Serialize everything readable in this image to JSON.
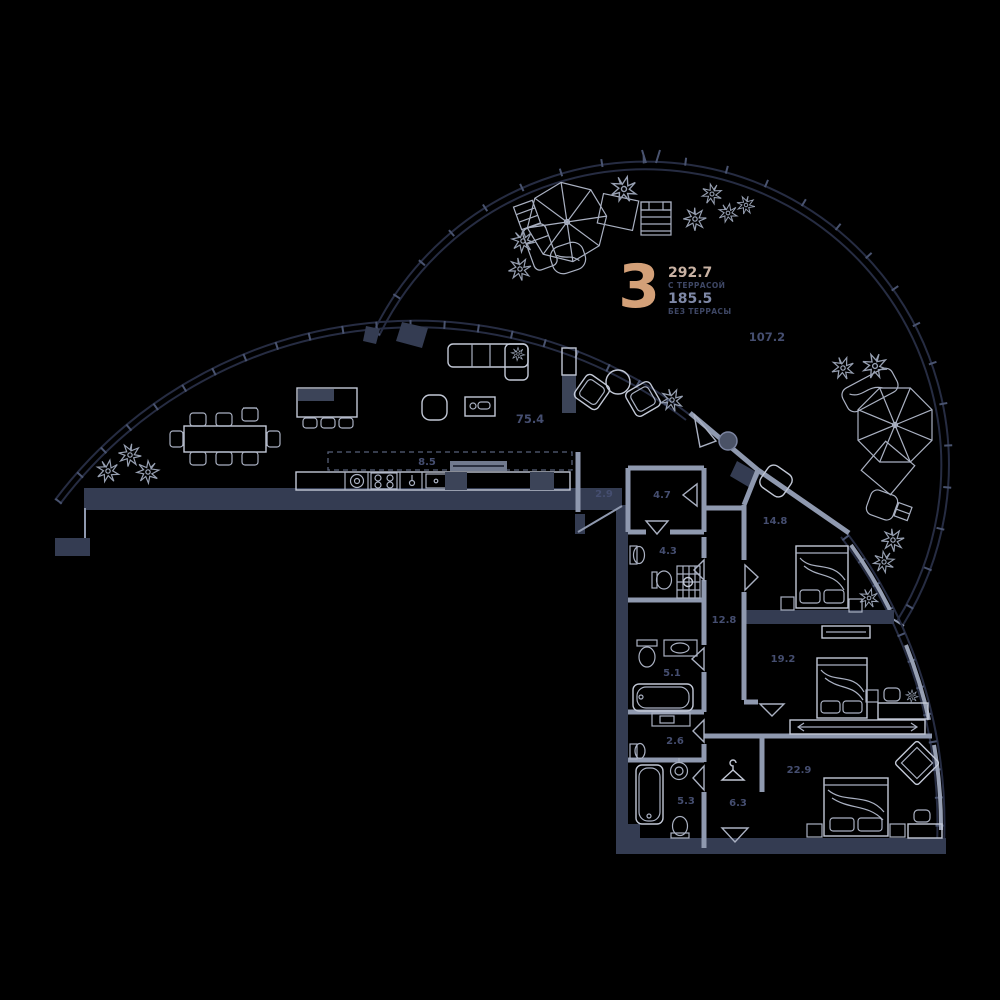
{
  "apartment": {
    "number": "3",
    "area_with_terrace": "292.7",
    "with_terrace_label": "С ТЕРРАСОЙ",
    "area_without_terrace": "185.5",
    "without_terrace_label": "БЕЗ ТЕРРАСЫ"
  },
  "rooms": {
    "terrace": "107.2",
    "living_kitchen": "75.4",
    "kitchen_zone": "8.5",
    "hall": "2.9",
    "entry": "4.7",
    "shower_room": "4.3",
    "corridor": "12.8",
    "bedroom_1": "14.8",
    "bathroom_1": "5.1",
    "bedroom_2": "19.2",
    "laundry": "2.6",
    "bathroom_2": "5.3",
    "wardrobe": "6.3",
    "bedroom_3": "22.9"
  },
  "colors": {
    "background": "#000000",
    "accent_number": "#d3a078",
    "area_with_terrace": "#c9b2a3",
    "area_without_terrace": "#7e88a6",
    "room_label": "#454e70",
    "wall_dark": "#343c52",
    "wall_light": "#8f99af",
    "furniture_line": "#c2c8d6",
    "arc_line": "#262c42"
  }
}
